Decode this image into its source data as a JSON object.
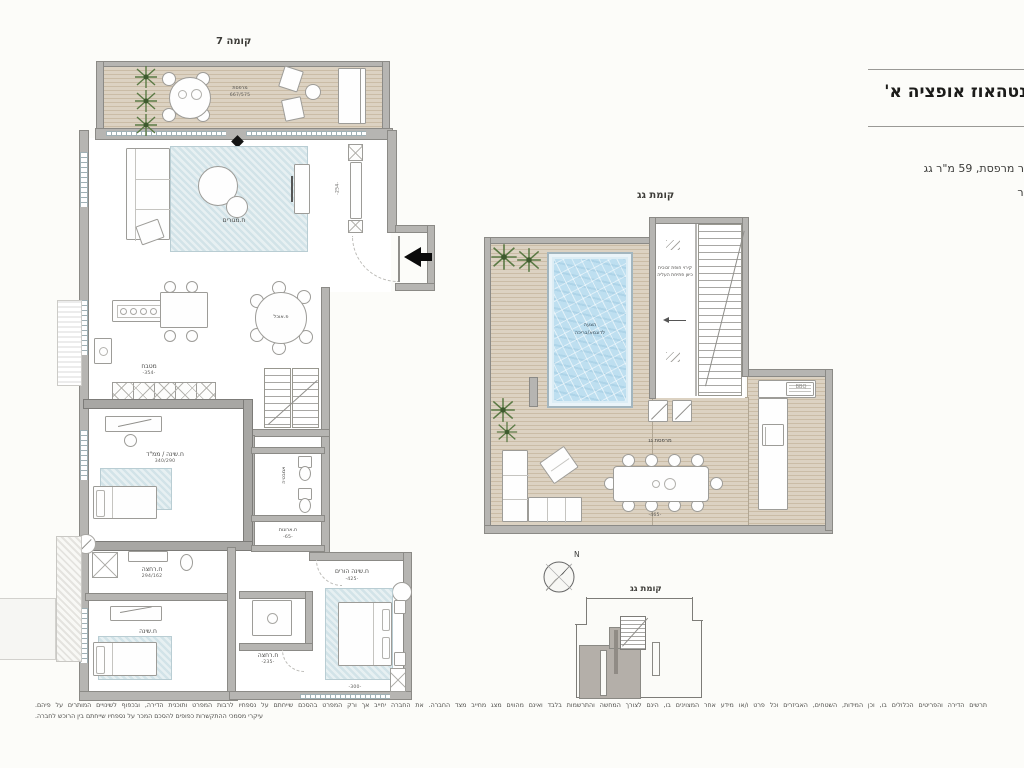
{
  "header": {
    "title": "פנטהאוז אופציה א'",
    "line1": "ר מרפסת, 59 מ\"ר גג",
    "line2": "יר"
  },
  "floor7": {
    "title": "קומה 7",
    "balcony": {
      "label": "מרפסת",
      "dim": "667/575"
    },
    "living": {
      "label": "ח.מגורים",
      "dim": "-413-"
    },
    "corridor_dim": "-254-",
    "kitchen": {
      "label": "מטבח",
      "dim": "-354-"
    },
    "dining": {
      "label": "פ.אוכל"
    },
    "mamad": {
      "label": "ח.שינה / ממ\"ד",
      "dim": "340/290"
    },
    "bath": {
      "label": "אמבטיה"
    },
    "closet": {
      "label": "ח.ארונות",
      "dim": "-65-"
    },
    "bath2": {
      "label": "ח.רחצה",
      "dim": "294/162"
    },
    "bedroom2": {
      "label": "ח.שינה"
    },
    "bath3": {
      "label": "ח.רחצה",
      "dim": "-235-"
    },
    "master": {
      "label": "ח.שינה הורים",
      "dim": "-425-",
      "bottom_dim": "-300-"
    }
  },
  "roof": {
    "title": "קומת גג",
    "pool": {
      "line1": "הצעה",
      "line2": "לדוגמא/בריכה"
    },
    "stair_note": "קירוי חופת זכוכית כיוון פתיחת העליה",
    "terrace_label": "מרפסת גג",
    "bbq_label": "BBQ",
    "dim": "-465-"
  },
  "keyplan": {
    "title": "קומת גג",
    "north": "N"
  },
  "disclaimer": {
    "line1": "תרשים הדירה והפריטים הכלולים בו, וכן המידות, השטחים, האביזרים וכל פרט ו/או מידע אחר המצוינים בו, הינם לצורך המחשה והתרשמות בלבד ואינם מהווים מצג מחייב מצד החברה. את החברה יחייב אך ורק המפרט בהסכם שייחתם על נספחיו לרבות המפרט ותוכנית הדירה, ובכפוף לשינויים המותרים על פיהם.",
    "line2": "עיקרי מסמכי ההתקשרות כפופים להסכם המכר על נספחיו שייחתם בין הרוכש לחברה."
  }
}
